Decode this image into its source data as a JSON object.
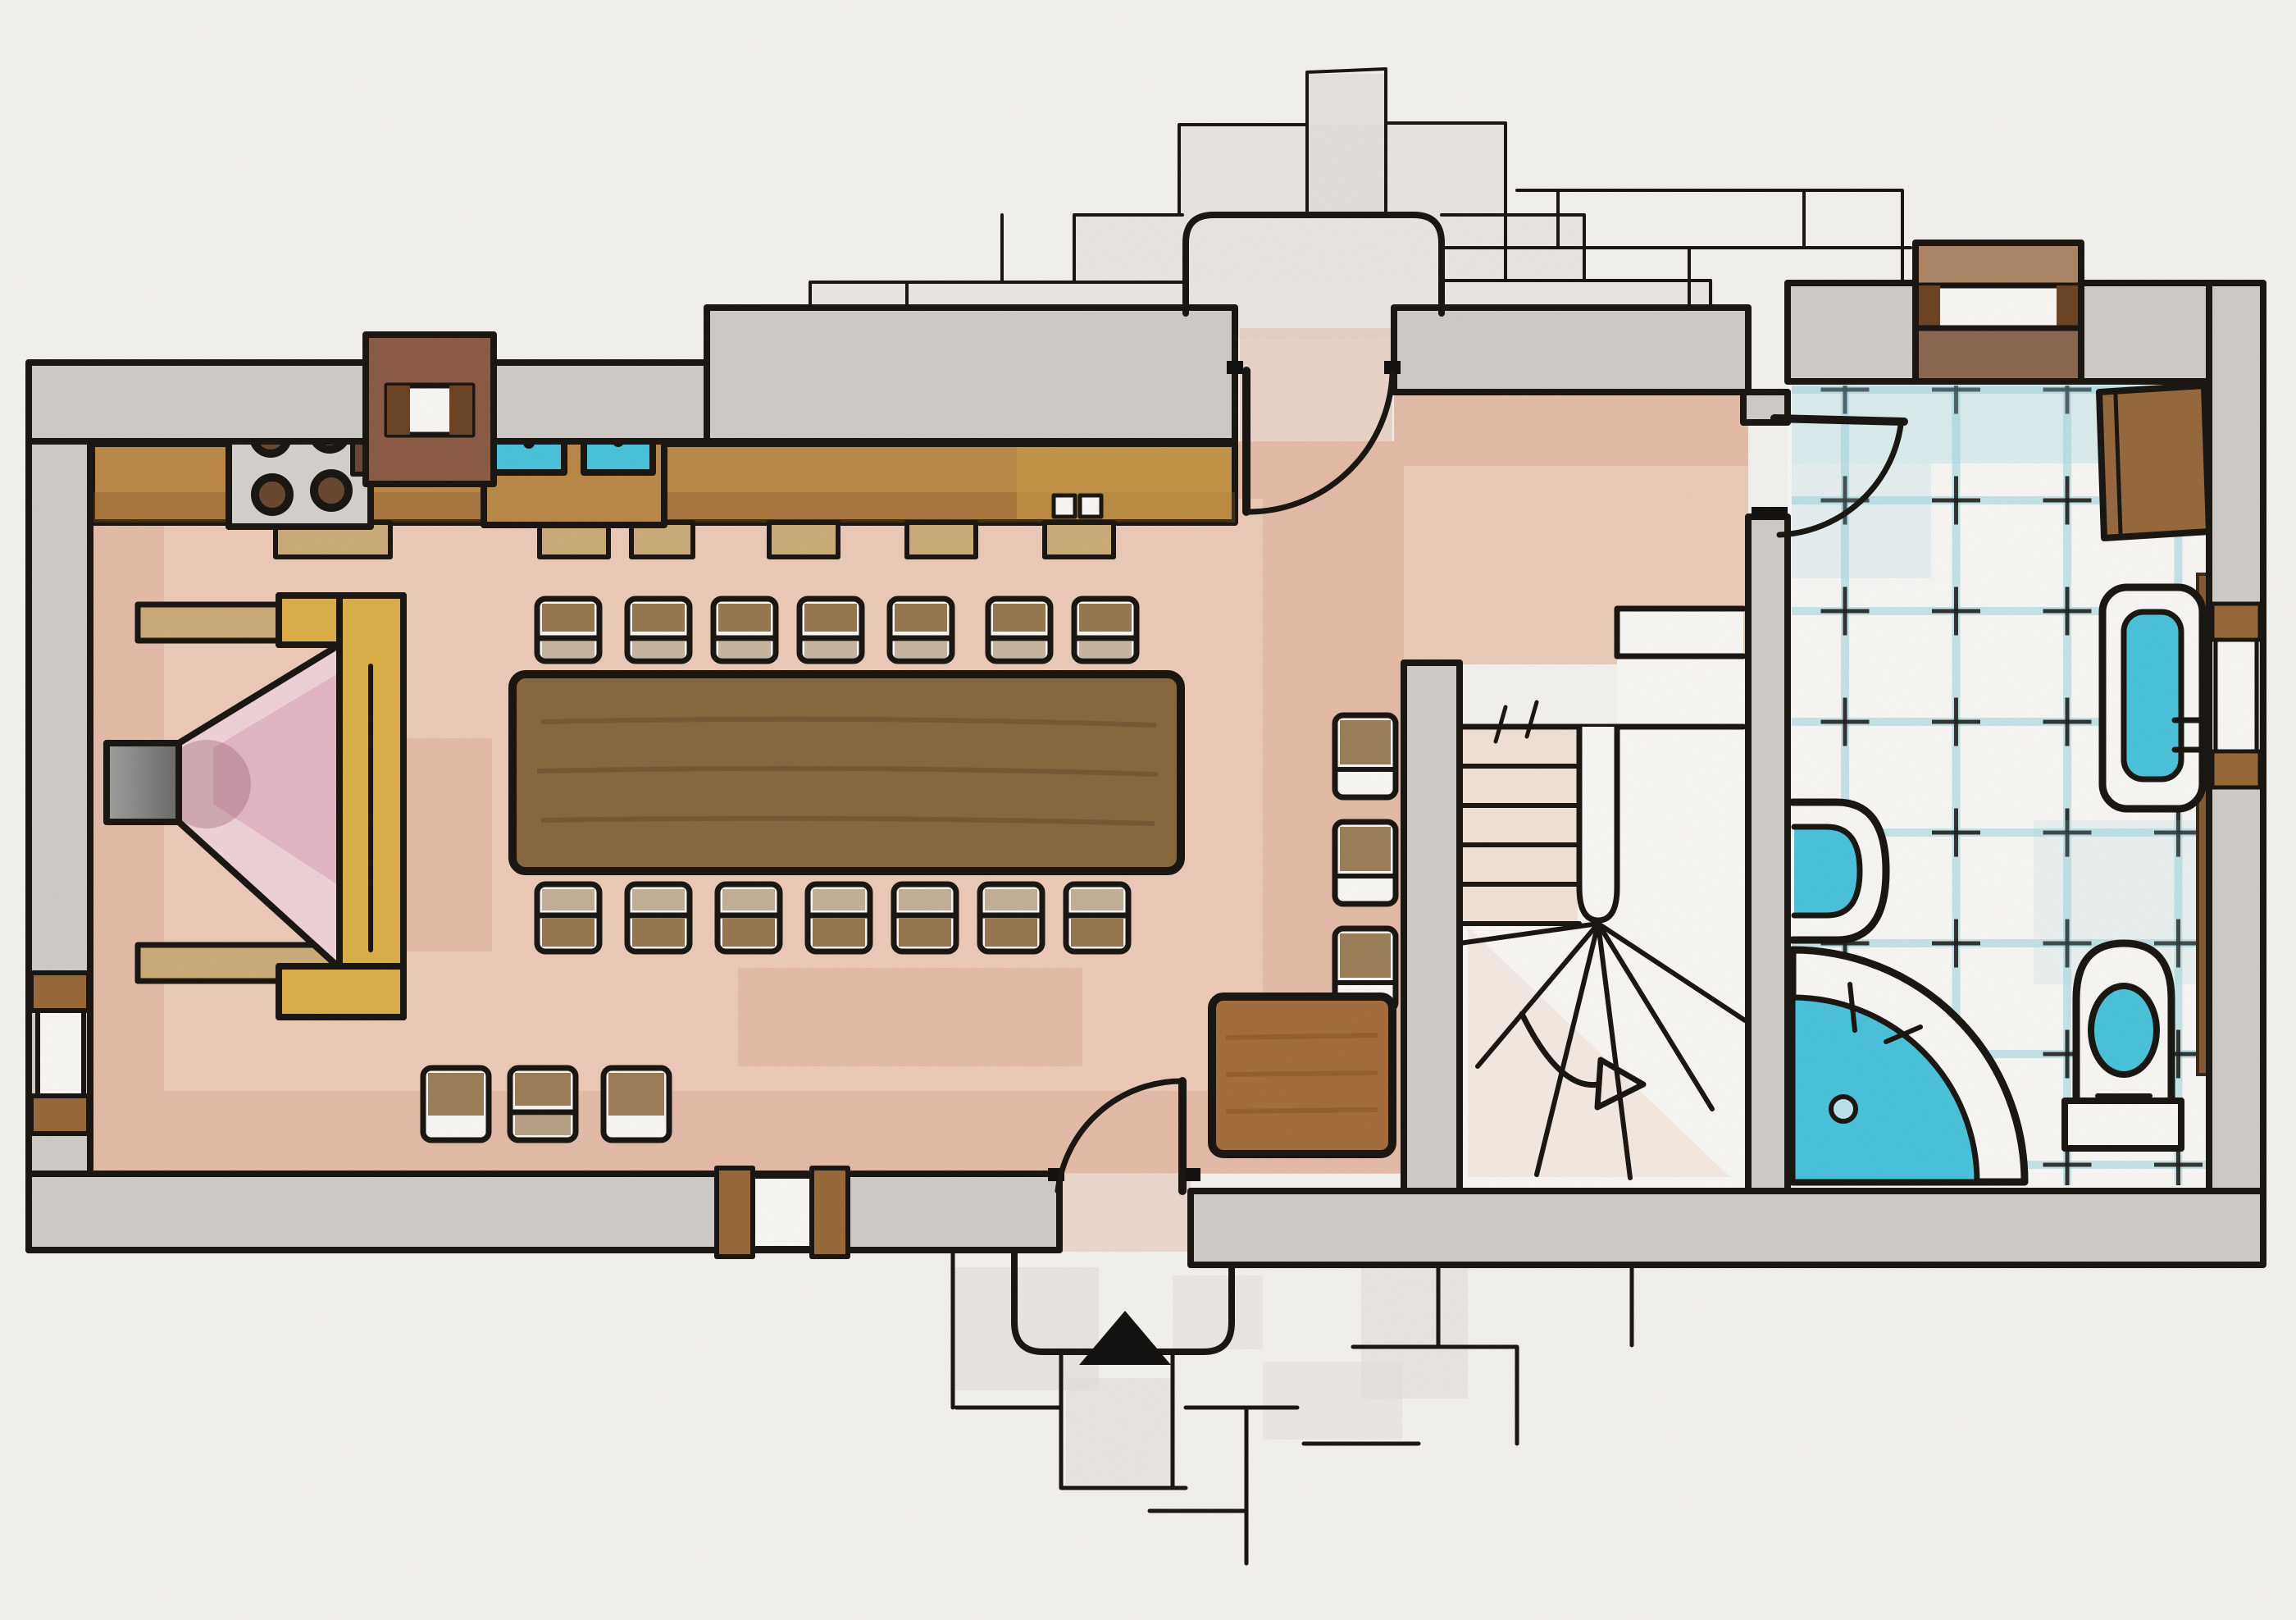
{
  "document": {
    "kind": "Hand-drawn ground floor plan",
    "style": "ink outlines with colored pencil shading",
    "orientation": "landscape"
  },
  "palette": {
    "paper": "#f8f7f4",
    "ink": "#1b1713",
    "wall": "#d4d0cc",
    "stone": "#e6e3df",
    "pink": "#f1cfbe",
    "pinkdark": "#cf8d72",
    "wood": "#bf8c4a",
    "wooddark": "#8b6a40",
    "tan": "#cfb07c",
    "gold": "#dfb34a",
    "teal": "#4cc7e0",
    "tile": "#9ed8e4",
    "chimney": "#8e5f49",
    "mat": "#a8703d",
    "flue": "#8e8e8e",
    "firepink": "#f2d7dd",
    "firemagenta": "#d98fae",
    "wincap": "#9c6b3b",
    "windark": "#6e4526"
  },
  "rooms": [
    {
      "id": "kitchen-dining",
      "label": "Kitchen / dining room",
      "floor": "pink pencil"
    },
    {
      "id": "entrance-hall",
      "label": "Entrance hall",
      "floor": "pink pencil"
    },
    {
      "id": "staircase",
      "label": "Winder staircase",
      "floor": "white with pink treads"
    },
    {
      "id": "bathroom",
      "label": "Bathroom",
      "floor": "blue tile grid"
    }
  ],
  "fixtures": {
    "kitchen": {
      "hob_burners": 4,
      "sink_basins": 2,
      "under_counter_units": 6,
      "counter": 1
    },
    "dining": {
      "table": 1,
      "chairs_north_row": 7,
      "chairs_south_row": 7,
      "stools_south_wall": 3,
      "stools_hall": 3
    },
    "fireplace": {
      "count": 1,
      "surround": "gold",
      "flue": "grey"
    },
    "bathroom": {
      "corner_shower": 1,
      "toilet": 1,
      "washbasin": 1,
      "wall_hung_basin": 1,
      "radiator": 1,
      "shelf_strip": 1
    },
    "doors": {
      "back_door": 1,
      "front_door": 1,
      "bathroom_door": 1
    },
    "windows": {
      "left_wall": 1,
      "south_wall": 1,
      "bathroom_north_wall": 1,
      "east_wall": 1
    },
    "chimney_on_north_wall": 1,
    "stair_direction_arrow": "curves down and points right",
    "entrance_marker": "solid black triangle on south porch"
  }
}
